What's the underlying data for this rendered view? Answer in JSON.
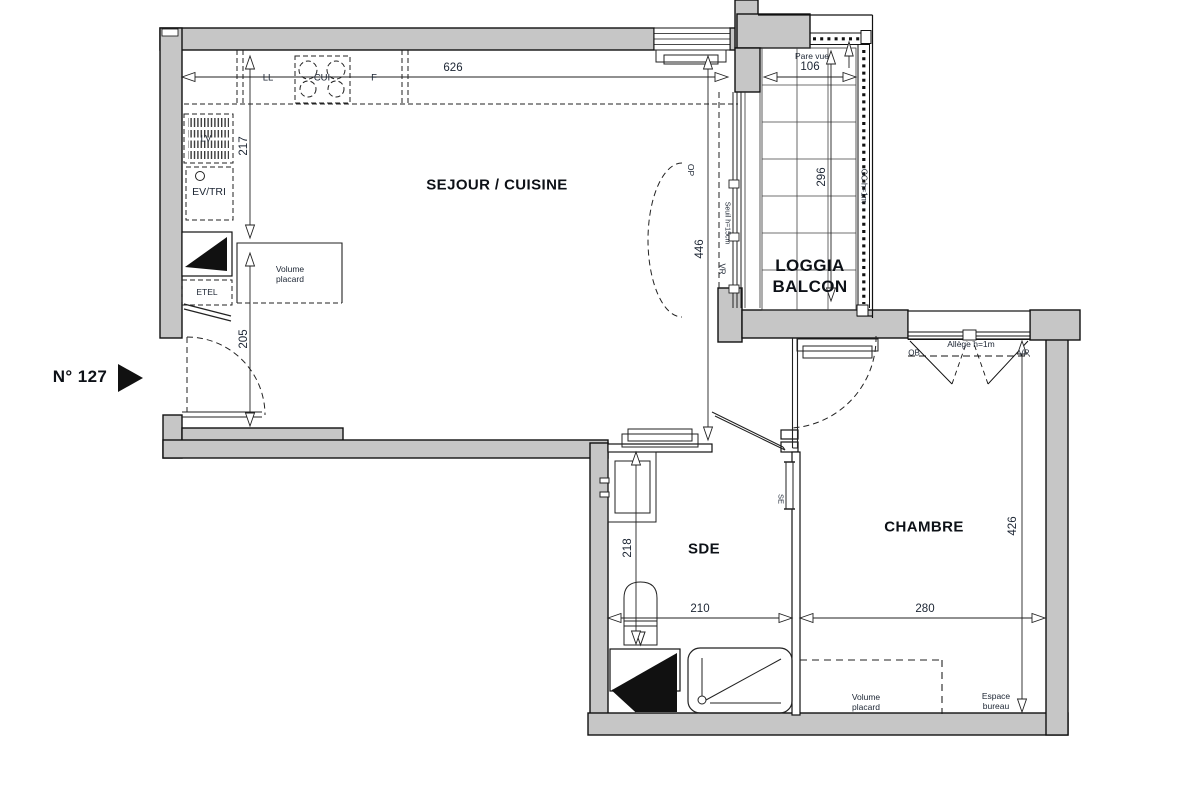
{
  "plan": {
    "unit_number": "N° 127",
    "rooms": {
      "sejour_cuisine": "SEJOUR / CUISINE",
      "loggia_line1": "LOGGIA",
      "loggia_line2": "BALCON",
      "sde": "SDE",
      "chambre": "CHAMBRE"
    },
    "dimensions_cm": {
      "sejour_width": "626",
      "kitchen_return": "217",
      "entry_zone": "205",
      "sejour_depth": "446",
      "loggia_width": "106",
      "loggia_depth": "296",
      "sde_depth": "218",
      "sde_width": "210",
      "chambre_width": "280",
      "chambre_depth": "426"
    },
    "annotations": {
      "pare_vue": "Pare vue",
      "garde_corps": "GC h=1m",
      "porte_fenetre": "OP",
      "seuil": "Seuil h=15cm",
      "volet_roulant_sejour": "VR",
      "allege": "Allège h=1m",
      "ouvrant_battant": "OB",
      "volet_roulant_chambre": "VR",
      "seche_serviettes": "SE",
      "volume_placard_sejour": "Volume placard",
      "volume_placard_chambre": "Volume placard",
      "espace_bureau": "Espace bureau"
    },
    "kitchen_appliances": {
      "lave_linge": "LL",
      "cuisson": "CUI",
      "frigo": "F",
      "lave_vaisselle": "LV",
      "evier_tri": "EV/TRI",
      "etel": "ETEL"
    },
    "colors": {
      "wall_fill": "#c6c6c6",
      "line": "#1a1a1a",
      "text": "#1c2533"
    }
  }
}
